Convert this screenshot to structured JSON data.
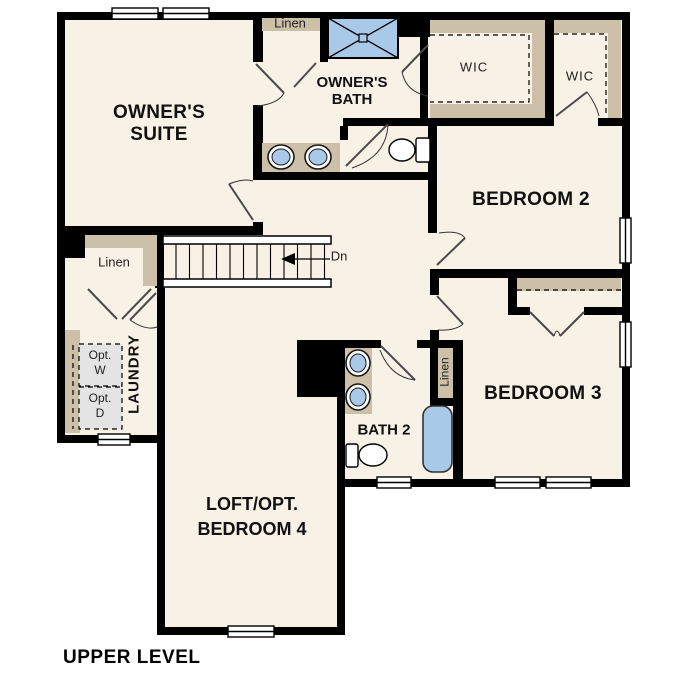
{
  "plan": {
    "title": "UPPER LEVEL",
    "rooms": {
      "owners_suite": {
        "line1": "OWNER'S",
        "line2": "SUITE"
      },
      "owners_bath": {
        "line1": "OWNER'S",
        "line2": "BATH"
      },
      "bedroom2": {
        "label": "BEDROOM 2"
      },
      "bedroom3": {
        "label": "BEDROOM 3"
      },
      "loft": {
        "line1": "LOFT/OPT.",
        "line2": "BEDROOM 4"
      },
      "bath2": {
        "label": "BATH 2"
      },
      "laundry": {
        "label": "LAUNDRY"
      },
      "wic1": {
        "label": "WIC"
      },
      "wic2": {
        "label": "WIC"
      },
      "linen_top": {
        "label": "Linen"
      },
      "linen_left": {
        "label": "Linen"
      },
      "linen_bath2": {
        "label": "Linen"
      }
    },
    "annotations": {
      "stairs_direction": "Dn",
      "opt_washer": {
        "line1": "Opt.",
        "line2": "W"
      },
      "opt_dryer": {
        "line1": "Opt.",
        "line2": "D"
      }
    },
    "colors": {
      "wall": "#000000",
      "floor": "#F8F1E5",
      "shelving": "#CCC0A8",
      "fixture_blue": "#A9C9E9",
      "appliance_gray": "#E4E4E4",
      "background": "#FFFFFF"
    }
  }
}
